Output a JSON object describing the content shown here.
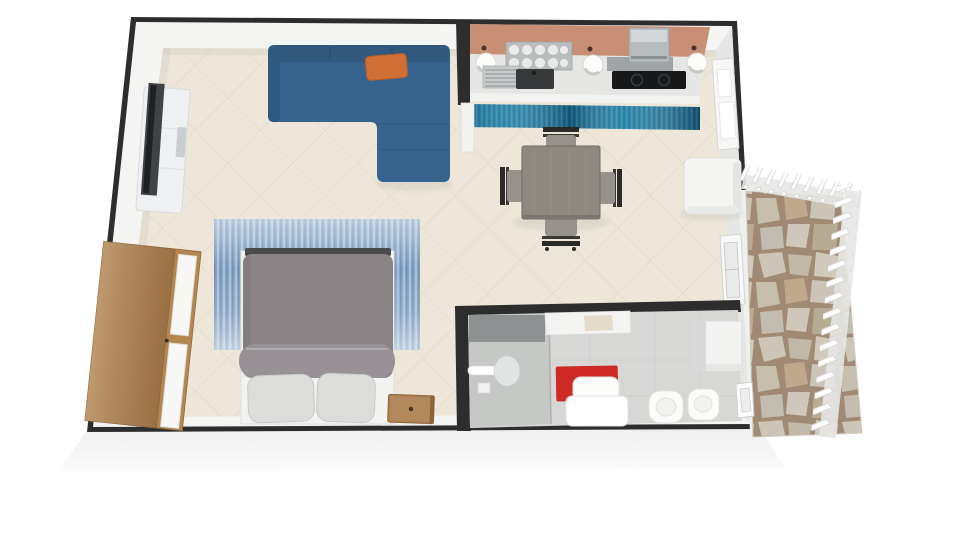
{
  "app": {
    "name": "3D Floor Plan Render",
    "view": "top-down 3d perspective",
    "description": "Rendered studio apartment floor plan with living/dining area, kitchenette, sleeping area, bathroom and stone patio"
  },
  "palette": {
    "background": "#FFFFFF",
    "wall_dark": "#2D2D2D",
    "wall_face_white": "#F4F4F3",
    "wall_face_gray": "#E6E6E5",
    "floor_tile": "#EDE6D9",
    "tile_line": "#DBD2BF",
    "sofa_blue": "#36648E",
    "sofa_shadow_blue": "#2F5A80",
    "pillow_orange": "#D06F35",
    "runner_teal": "#1E7FA8",
    "rug_blue": "#7E9FC2",
    "bed_duvet_gray": "#8B8487",
    "bed_fold_gray": "#989296",
    "bed_pillow_gray": "#DCDCDB",
    "wood_wardrobe": "#B2834F",
    "wood_nightstand": "#A87E50",
    "table_gray": "#8E8880",
    "chair_seat_gray": "#96918A",
    "chair_frame_dark": "#2C2A28",
    "kitchen_backsplash": "#C98F75",
    "counter_gray": "#E6E7E5",
    "cooktop_black": "#17181A",
    "appliance_gray": "#B7BCBF",
    "bathroom_floor": "#D7D8D6",
    "shower_floor": "#C6C8C6",
    "shower_panel_gray": "#8E9191",
    "bath_mat_red": "#CE2A25",
    "fixture_white": "#FBFBFA",
    "cube_white": "#F4F4F3",
    "patio_grout": "#A08A74",
    "patio_stone": "#CCC5B8",
    "railing_white": "#FDFDFD"
  },
  "rooms": [
    {
      "id": "living-dining",
      "label": "Living / dining area",
      "floor": "beige diagonal tiles"
    },
    {
      "id": "kitchen",
      "label": "Kitchenette",
      "floor": "beige tiles",
      "accent_wall": "copper backsplash"
    },
    {
      "id": "sleeping-area",
      "label": "Sleeping area",
      "floor": "beige tiles"
    },
    {
      "id": "bathroom",
      "label": "Bathroom",
      "floor": "gray tiles"
    },
    {
      "id": "patio",
      "label": "Patio / terrace",
      "floor": "natural flagstone"
    }
  ],
  "furniture": [
    {
      "id": "tv-stand",
      "label": "White TV lowboard",
      "room": "living-dining"
    },
    {
      "id": "tv",
      "label": "Flat screen TV",
      "room": "living-dining"
    },
    {
      "id": "sectional-sofa",
      "label": "Blue L-shaped sectional sofa",
      "room": "living-dining"
    },
    {
      "id": "accent-pillow",
      "label": "Orange accent pillow",
      "room": "living-dining"
    },
    {
      "id": "dining-table",
      "label": "Square gray dining table",
      "room": "living-dining"
    },
    {
      "id": "dining-chair",
      "label": "Dining chair",
      "count": 4,
      "room": "living-dining"
    },
    {
      "id": "storage-cube",
      "label": "White storage cube / mini fridge",
      "room": "living-dining"
    },
    {
      "id": "kitchen-counter",
      "label": "Kitchen counter",
      "room": "kitchen"
    },
    {
      "id": "dish-rack",
      "label": "Dish rack with plates",
      "room": "kitchen"
    },
    {
      "id": "sink",
      "label": "Sink with drainboard",
      "room": "kitchen"
    },
    {
      "id": "cooktop",
      "label": "Black cooktop",
      "room": "kitchen"
    },
    {
      "id": "microwave",
      "label": "Countertop appliance",
      "room": "kitchen"
    },
    {
      "id": "counter-bowl",
      "label": "White round bowl",
      "count": 3,
      "room": "kitchen"
    },
    {
      "id": "kitchen-runner",
      "label": "Teal runner rug",
      "room": "kitchen"
    },
    {
      "id": "patio-door",
      "label": "White paneled door",
      "room": "kitchen"
    },
    {
      "id": "living-window",
      "label": "Window on right wall",
      "room": "living-dining"
    },
    {
      "id": "area-rug",
      "label": "Blue streaked area rug",
      "room": "sleeping-area"
    },
    {
      "id": "double-bed",
      "label": "Double bed with gray duvet",
      "room": "sleeping-area"
    },
    {
      "id": "bed-pillow",
      "label": "Bed pillow",
      "count": 2,
      "room": "sleeping-area"
    },
    {
      "id": "nightstand",
      "label": "Wooden nightstand",
      "room": "sleeping-area"
    },
    {
      "id": "wardrobe",
      "label": "Wooden wardrobe with open white doors",
      "room": "sleeping-area"
    },
    {
      "id": "shower",
      "label": "Walk-in shower",
      "room": "bathroom"
    },
    {
      "id": "grab-bar",
      "label": "Grab bar / door handle",
      "room": "bathroom"
    },
    {
      "id": "washbasin",
      "label": "Washbasin",
      "room": "bathroom"
    },
    {
      "id": "bath-mat",
      "label": "Red bath mat",
      "room": "bathroom"
    },
    {
      "id": "bath-lounger",
      "label": "White tub seat",
      "room": "bathroom"
    },
    {
      "id": "wall-shelf",
      "label": "Wall shelf",
      "room": "bathroom"
    },
    {
      "id": "bathroom-cabinet",
      "label": "Storage cabinet",
      "room": "bathroom"
    },
    {
      "id": "toilet",
      "label": "Toilet",
      "room": "bathroom"
    },
    {
      "id": "bidet",
      "label": "Bidet",
      "room": "bathroom"
    },
    {
      "id": "bathroom-window",
      "label": "Bathroom window",
      "room": "bathroom"
    },
    {
      "id": "stone-floor",
      "label": "Flagstone paving",
      "room": "patio"
    },
    {
      "id": "patio-railing",
      "label": "White slatted railing",
      "room": "patio"
    }
  ]
}
